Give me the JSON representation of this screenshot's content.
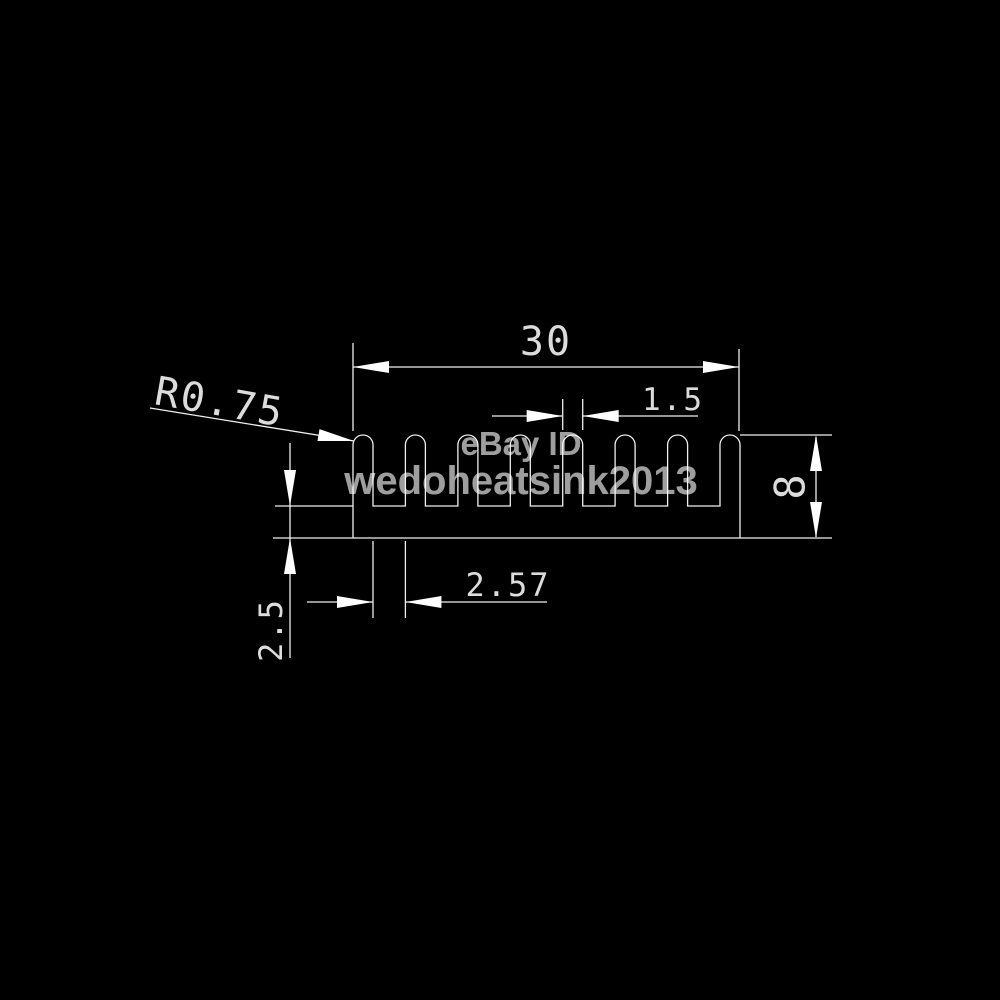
{
  "watermark": {
    "line1": "eBay ID",
    "line2": "wedoheatsink2013",
    "color": "#9d9d9d"
  },
  "drawing": {
    "background_color": "#000000",
    "line_color": "#efefef",
    "text_color": "#dcdcdc",
    "part": "heatsink-cross-section-profile",
    "fin_count": 8,
    "dimensions": {
      "overall_width": "30",
      "fin_width": "1.5",
      "fin_tip_radius": "R0.75",
      "overall_height": "8",
      "base_thickness": "2.5",
      "fin_gap": "2.57"
    }
  }
}
